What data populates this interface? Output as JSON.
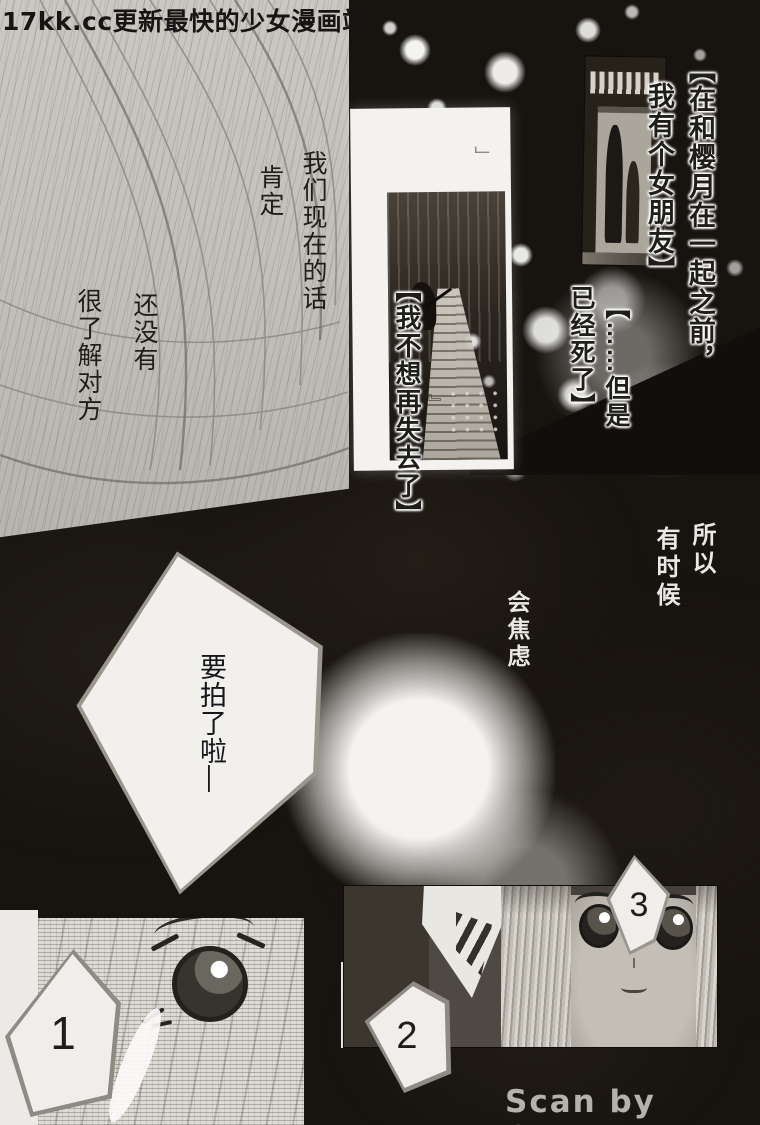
{
  "page": {
    "watermark": "17kk.cc更新最快的少女漫画站",
    "credit": "Scan by Osora"
  },
  "colors": {
    "background": "#17130f",
    "panel_light": "#c6c3bd",
    "ink": "#1a1a1a",
    "light_text": "#eae8e4"
  },
  "texts": {
    "monologue_current_1": "我们现在的话",
    "monologue_current_2": "肯定",
    "monologue_notyet_1": "还没有",
    "monologue_notyet_2": "很了解对方",
    "caption_girlfriend_1": "【在和樱月在一起之前，",
    "caption_girlfriend_2": "我有个女朋友】",
    "caption_dead_1": "【……但是",
    "caption_dead_2": "已经死了】",
    "caption_lose": "【我不想再失去了】",
    "quote_tail": "』",
    "quote_mark": "」",
    "monologue_so_1": "所以",
    "monologue_so_2": "有时候",
    "monologue_anxious": "会焦虑",
    "speech_photo": "要拍了啦—"
  },
  "panel_numbers": {
    "n1": "1",
    "n2": "2",
    "n3": "3"
  }
}
